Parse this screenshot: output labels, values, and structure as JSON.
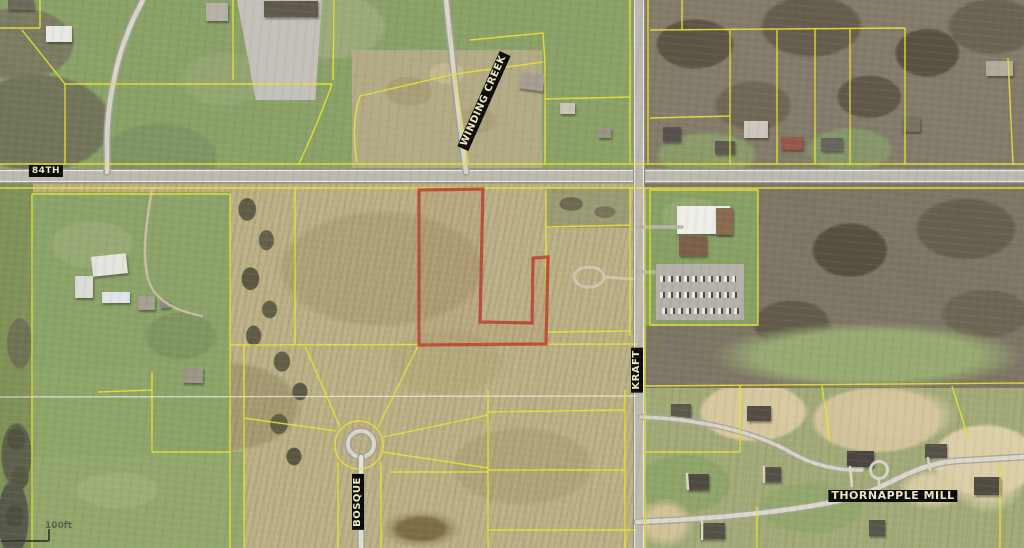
{
  "map": {
    "street_labels": [
      {
        "id": "84th",
        "text": "84TH"
      },
      {
        "id": "winding-creek",
        "text": "WINDING CREEK"
      },
      {
        "id": "kraft",
        "text": "KRAFT"
      },
      {
        "id": "bosque",
        "text": "BOSQUE"
      },
      {
        "id": "thornapple-mill",
        "text": "THORNAPPLE MILL"
      }
    ],
    "scale_text": "100ft",
    "colors": {
      "parcel_line": "#e8e332",
      "selected_parcel_outline": "#bb4233",
      "road_fill": "#bcb9b0",
      "road_edge": "#ecebe2",
      "label_text": "#efe8c8",
      "label_background": "#0a0a06"
    }
  }
}
